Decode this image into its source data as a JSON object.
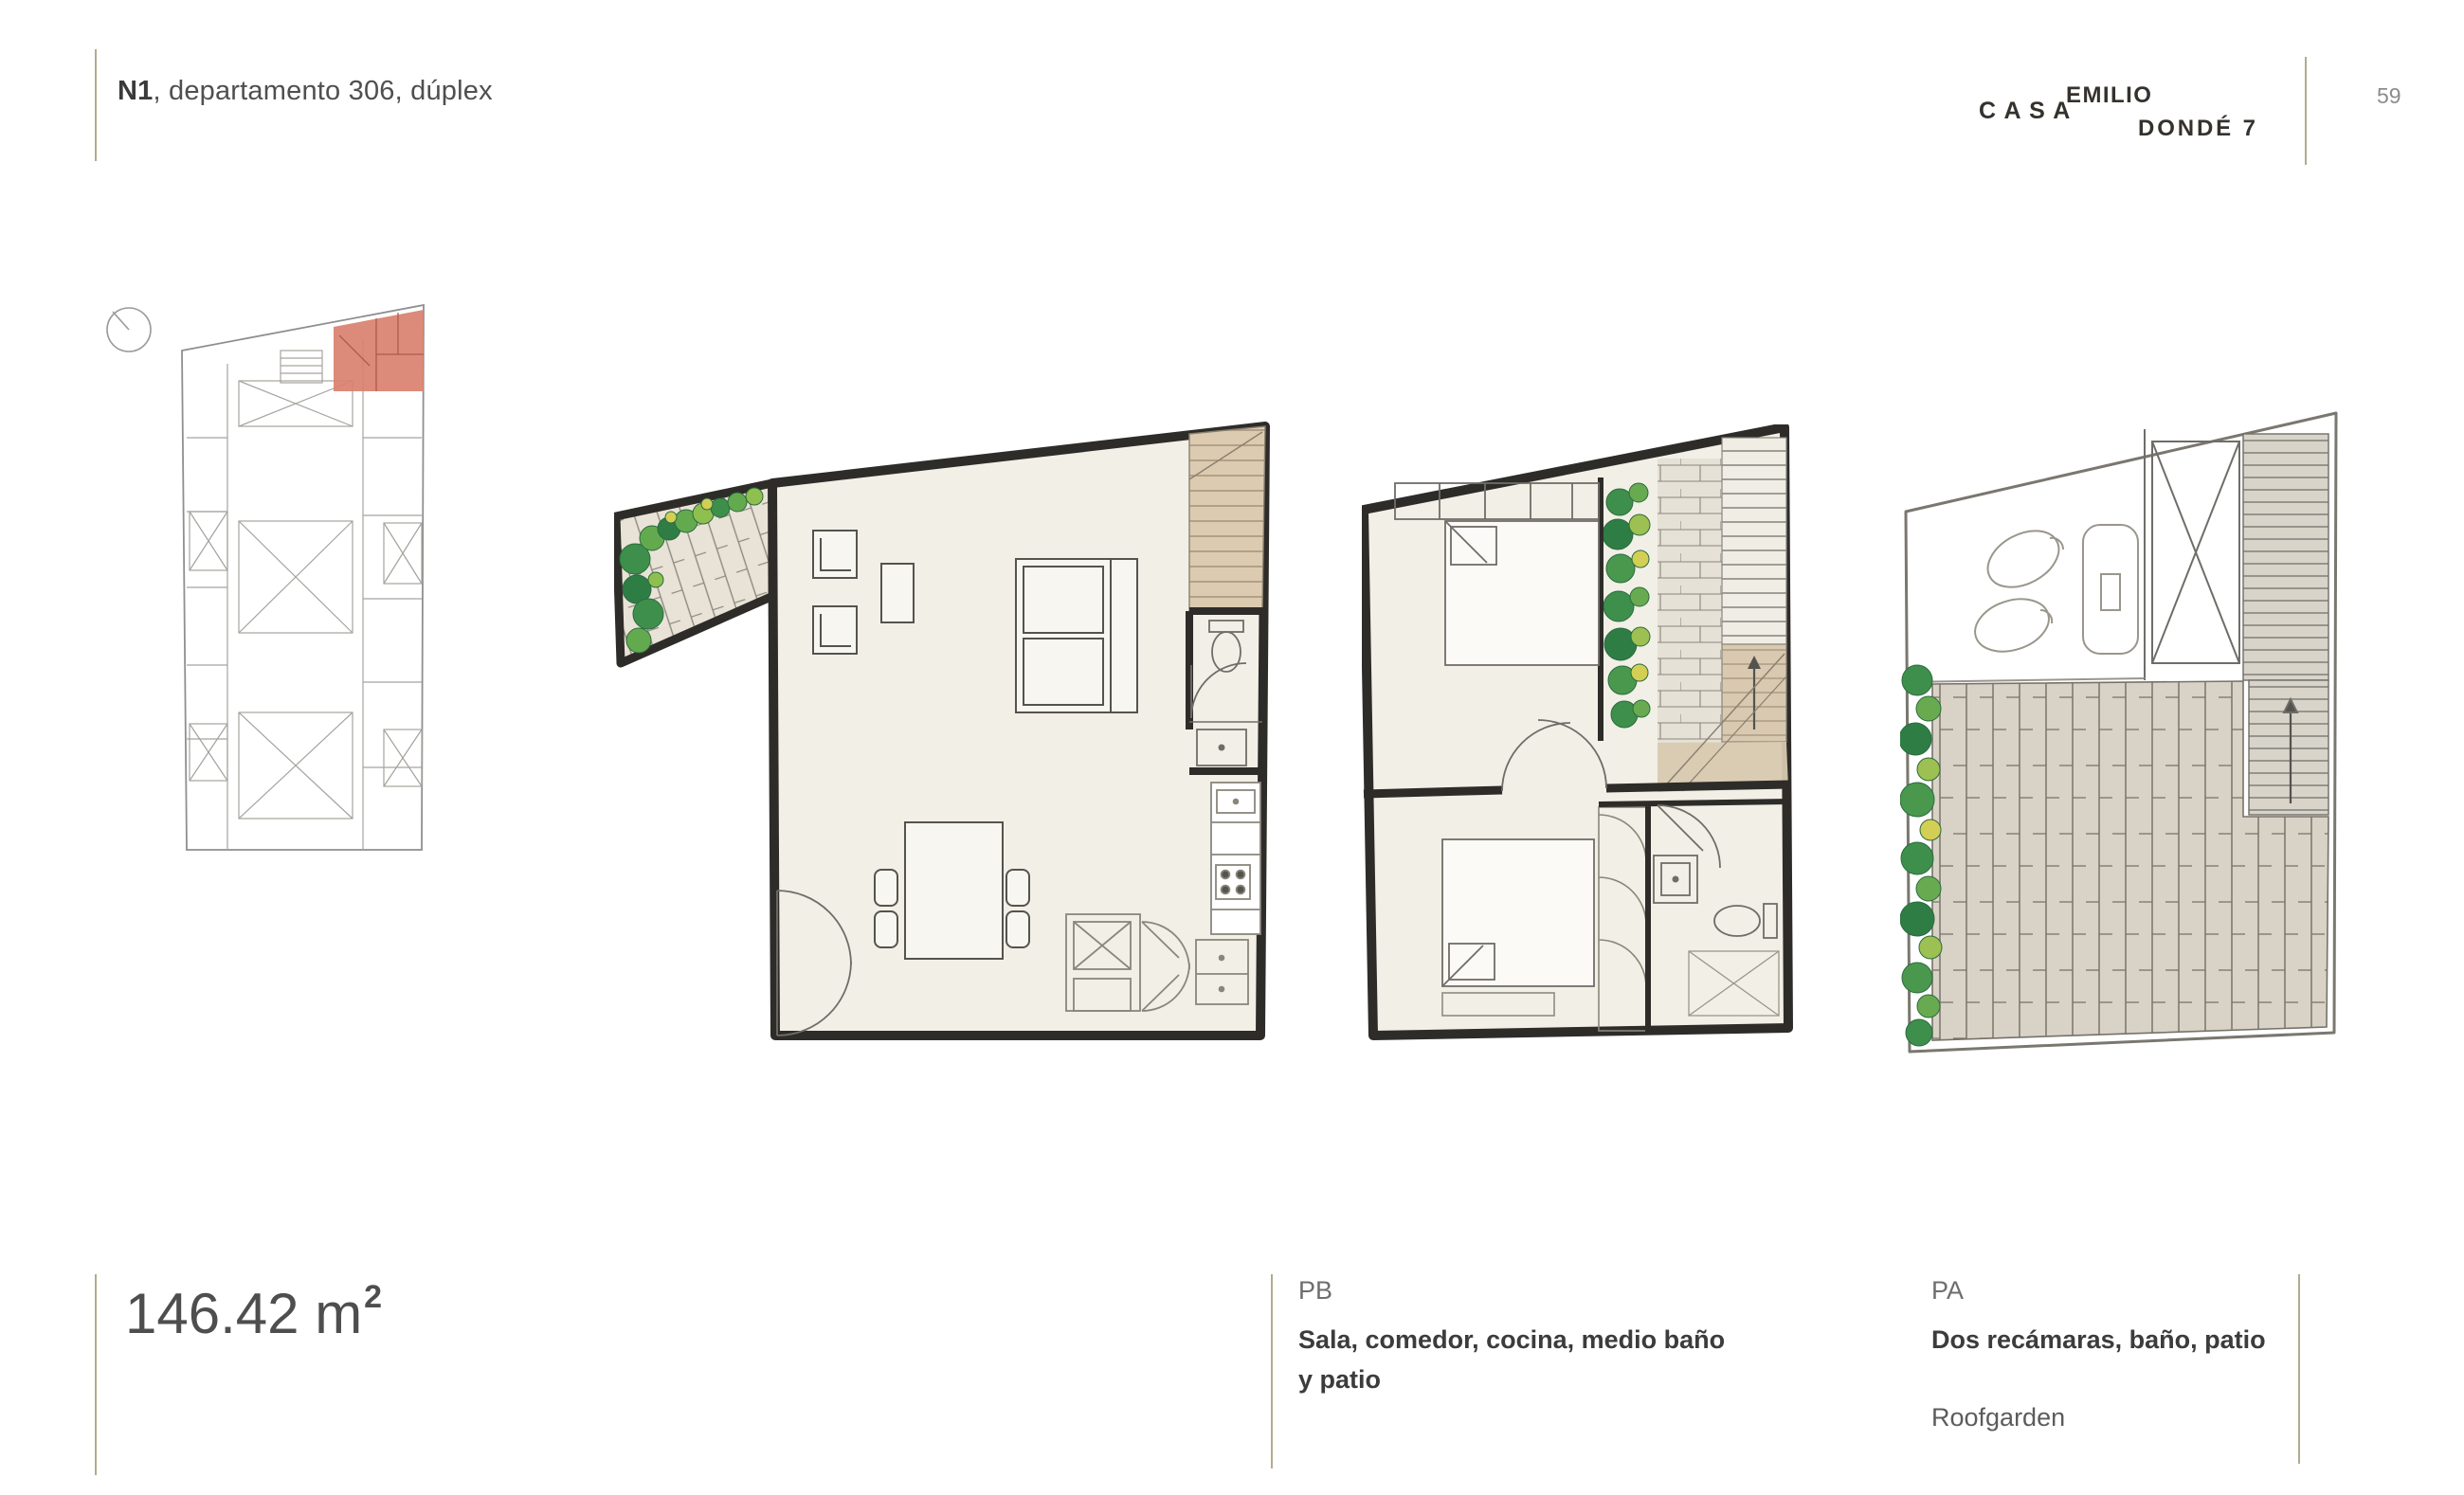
{
  "header": {
    "title_bold": "N1",
    "title_rest": ", departamento 306, dúplex",
    "page_number": "59"
  },
  "logo": {
    "casa": "CASA",
    "line1": "EMILIO",
    "line2": "DONDÉ 7"
  },
  "area": {
    "value": "146.42",
    "unit": "m",
    "exponent": "2"
  },
  "captions": {
    "pb": {
      "label": "PB",
      "line1": "Sala, comedor, cocina, medio baño",
      "line2": "y patio"
    },
    "pa": {
      "label": "PA",
      "line1": "Dos recámaras, baño, patio",
      "extra": "Roofgarden"
    }
  },
  "colors": {
    "accent_rule": "#b3ab8e",
    "highlight_unit": "#d9806f",
    "wall": "#2e2c29",
    "floor": "#f1efe6",
    "stair_tan": "#dccbb0",
    "deck": "#d8d3c6",
    "vegetation_green": "#3e8f4c"
  }
}
